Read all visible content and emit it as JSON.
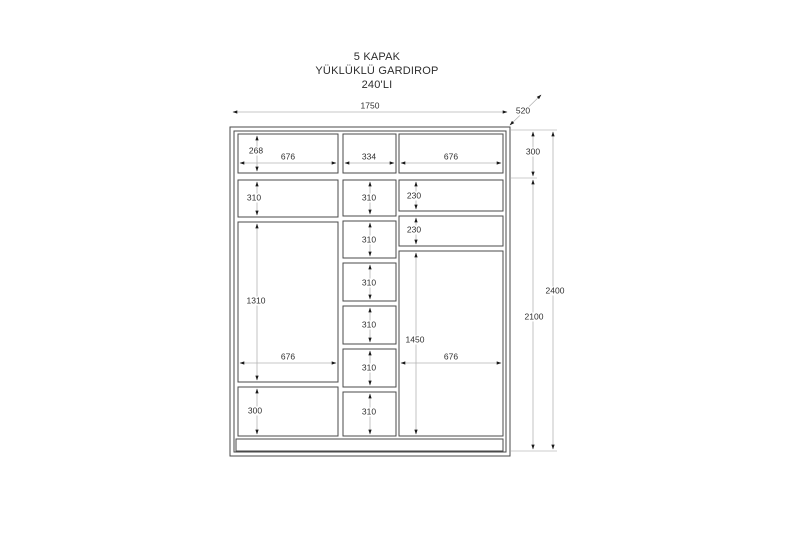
{
  "title": {
    "line1": "5 KAPAK",
    "line2": "YÜKLÜKLÜ GARDIROP",
    "line3": "240'LI"
  },
  "colors": {
    "outline": "#4a4a4a",
    "dimension_line": "#b4b4b4",
    "arrow": "#1a1a1a",
    "text": "#2f2f2f",
    "background": "#ffffff"
  },
  "dims": {
    "overall_width": "1750",
    "depth": "520",
    "top_section_height": "300",
    "body_interior_height": "2100",
    "total_height": "2400",
    "top_row": {
      "left_height": "268",
      "left_width": "676",
      "mid_width": "334",
      "right_width": "676"
    },
    "left_column": {
      "shelf_height": "310",
      "main_height": "1310",
      "main_width": "676",
      "bottom_height": "300"
    },
    "mid_column": {
      "shelf_heights": [
        "310",
        "310",
        "310",
        "310",
        "310",
        "310"
      ]
    },
    "right_column": {
      "shelf_heights": [
        "230",
        "230"
      ],
      "main_height": "1450",
      "main_width": "676"
    }
  }
}
